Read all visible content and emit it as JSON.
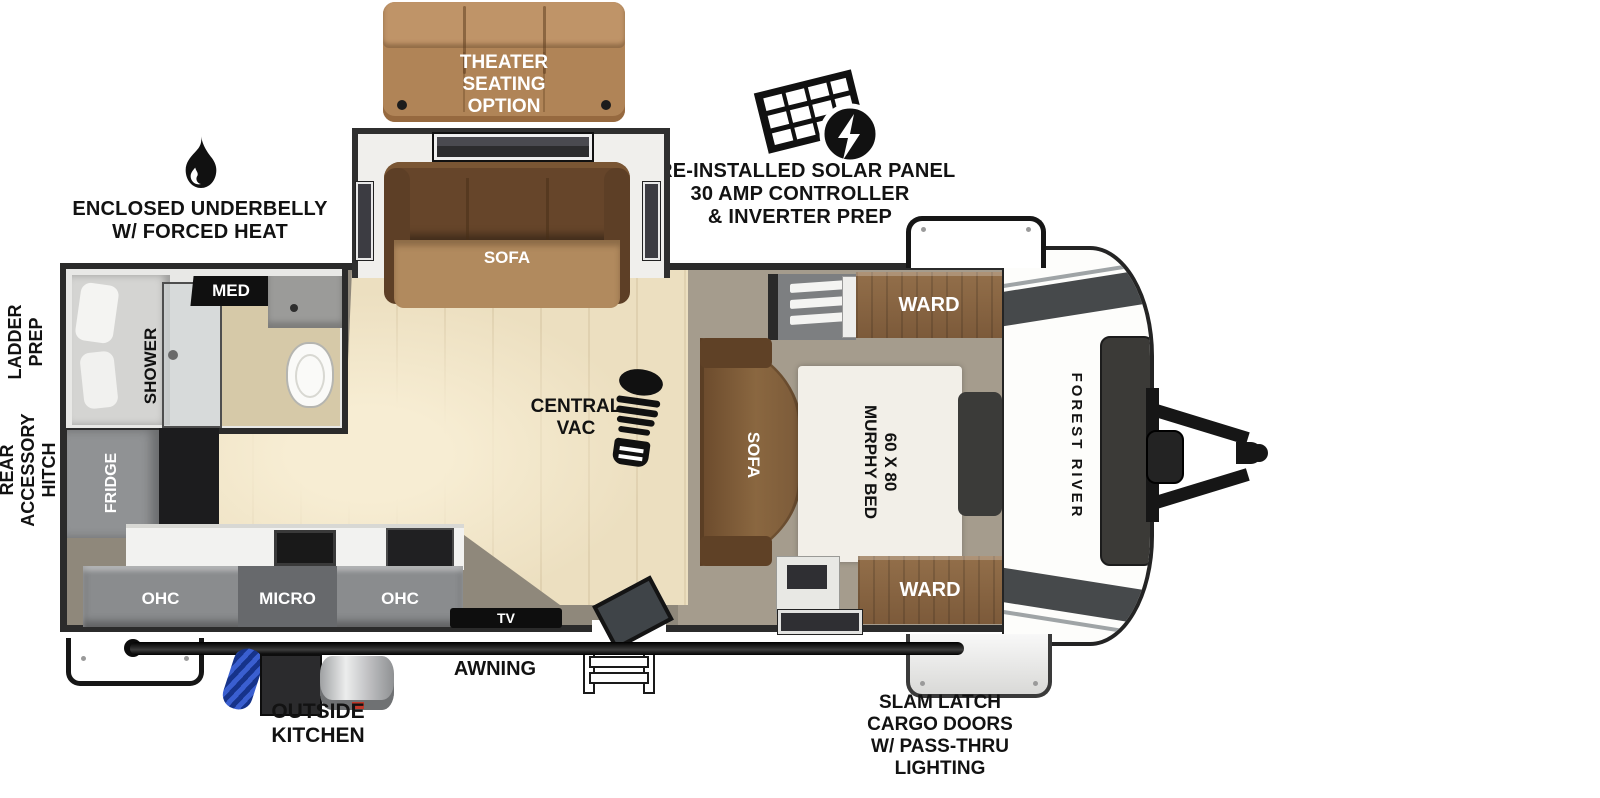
{
  "callouts": {
    "theater_seating": "THEATER\nSEATING\nOPTION",
    "solar": "PRE-INSTALLED SOLAR PANEL\n30 AMP CONTROLLER\n& INVERTER PREP",
    "underbelly": "ENCLOSED UNDERBELLY\nW/ FORCED HEAT",
    "ladder_prep": "LADDER\nPREP",
    "rear_accessory_hitch": "REAR\nACCESSORY\nHITCH",
    "central_vac": "CENTRAL\nVAC",
    "awning": "AWNING",
    "outside_kitchen": "OUTSIDE\nKITCHEN",
    "cargo_doors": "SLAM LATCH\nCARGO DOORS\nW/ PASS-THRU\nLIGHTING"
  },
  "labels": {
    "slide_sofa": "SOFA",
    "bed_sofa": "SOFA",
    "murphy_bed": "60 X 80\nMURPHY BED",
    "ward_top": "WARD",
    "ward_bottom": "WARD",
    "med_cabinet": "MED",
    "shower": "SHOWER",
    "fridge": "FRIDGE",
    "ohc_left": "OHC",
    "micro": "MICRO",
    "ohc_right": "OHC",
    "tv": "TV",
    "brand": "FOREST RIVER"
  },
  "icons": {
    "underbelly": "flame-icon",
    "solar": "solar-panel-icon",
    "central_vac": "boot-print-icon"
  },
  "colors": {
    "wall": "#2b2b2b",
    "wood_floor": "#ecdfc0",
    "bedroom_floor": "#a59c8d",
    "couch_tan": "#b08457",
    "sofa_brown": "#7b5a39",
    "ward_wood": "#8a6946",
    "cabinet_gray": "#8b8d8f",
    "micro_gray": "#67696c",
    "accent_black": "#161616"
  }
}
